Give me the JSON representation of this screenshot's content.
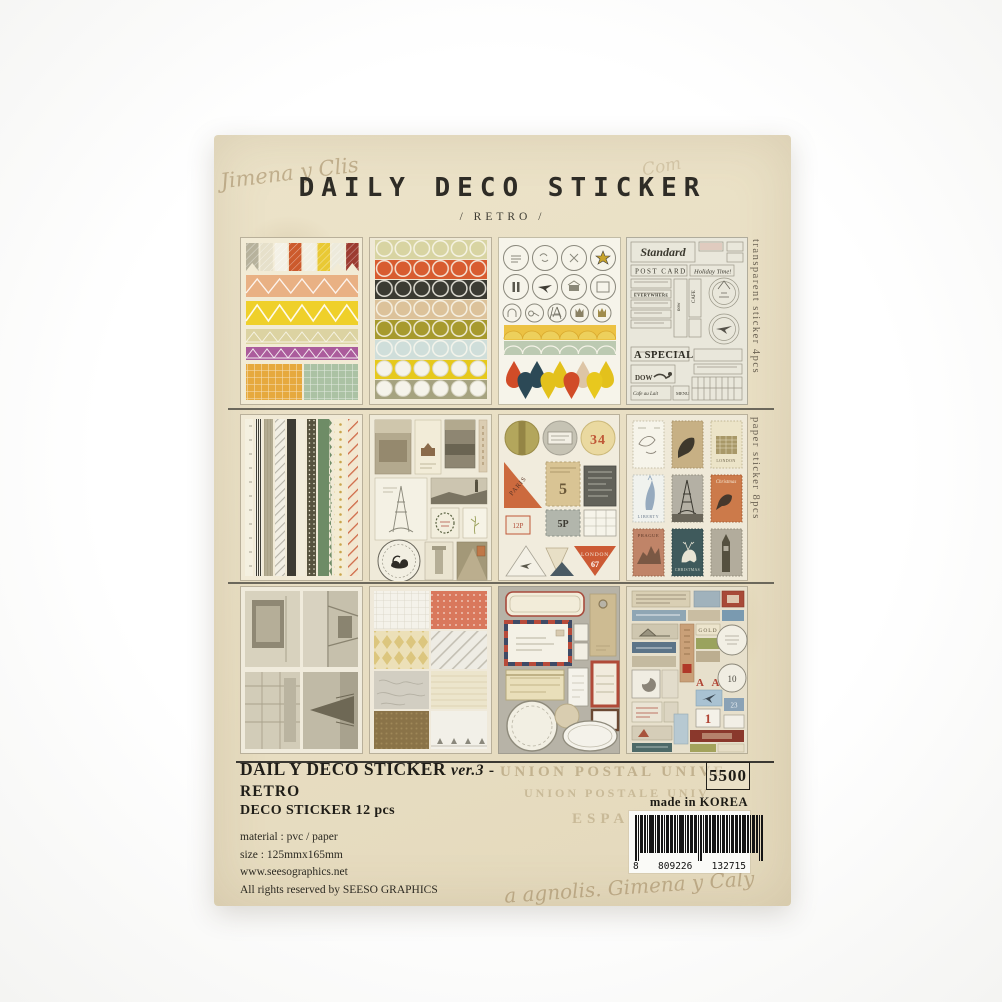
{
  "package": {
    "title": "DAILY DECO STICKER",
    "subtitle": "/ RETRO /",
    "side_labels": {
      "top": "transparent sticker 4pcs",
      "middle": "paper sticker 8pcs"
    },
    "handwriting": {
      "top_left": "Jimena y Clis",
      "top_right": "Com",
      "bottom": "a agnolis. Gimena y Caly"
    },
    "watermarks": {
      "line1": "UNION POSTAL UNIVE",
      "line2": "UNION POSTALE UNIV",
      "line3": "ESPA"
    }
  },
  "info": {
    "product_title": "DAIL Y DECO STICKER",
    "product_version": "ver.3",
    "product_suffix": "- RETRO",
    "product_subtitle": "DECO STICKER 12 pcs",
    "material": "material : pvc / paper",
    "size": "size : 125mmx165mm",
    "website": "www.seesographics.net",
    "rights": "All rights reserved by SEESO GRAPHICS",
    "price": "5500",
    "origin": "made in KOREA",
    "barcode": {
      "d1": "8",
      "d2": "809226",
      "d3": "132715"
    }
  },
  "sheet_texts": {
    "standard": "Standard",
    "post_card": "POST CARD",
    "holiday": "Holiday Time!",
    "everywhere": "EVERYWHERE",
    "now": "now",
    "cafe": "CAFE",
    "a_special": "A SPECIAL",
    "dow": "DOW",
    "cafe_au_lait": "Cafe au Lait",
    "menu": "MENU",
    "num34": "34",
    "paris": "PARIS",
    "num5": "5",
    "num5p": "5P",
    "num12p": "12P",
    "london_tri": "LONDON",
    "num67": "67",
    "liberty": "LIBERTY",
    "christmas_sm": "Christmas",
    "prague": "PRAGUE",
    "christmas_lg": "CHRISTMAS",
    "london_stamp": "LONDON",
    "gold": "GOLD",
    "aa": "A A",
    "num1": "1",
    "num10": "10",
    "num23": "23"
  },
  "colors": {
    "package": "#e9dfc4",
    "accent_red": "#b04a38",
    "ink": "#2e2c26"
  }
}
